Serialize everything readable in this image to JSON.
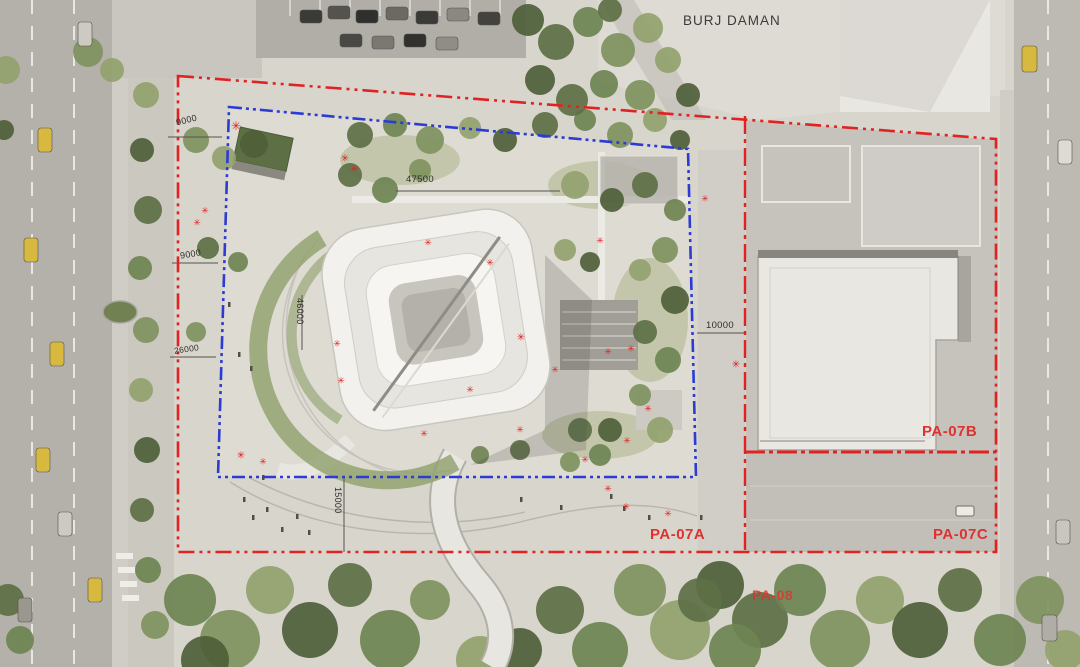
{
  "plan": {
    "building_label": "BURJ DAMAN",
    "plot_labels": {
      "pa07a": "PA-07A",
      "pa07b": "PA-07B",
      "pa07c": "PA-07C",
      "pa08": "PA-08"
    },
    "dimensions": {
      "top_left": "9000",
      "left_upper": "9000",
      "left_lower": "26000",
      "top_center": "47500",
      "building_left": "46000",
      "right_setback": "10000",
      "bottom_setback": "15000"
    },
    "colors": {
      "boundary_red": "#e02222",
      "boundary_blue": "#2c3cd2",
      "plot_label_red": "#e03030",
      "dimension_text": "#2f2d2a"
    }
  }
}
